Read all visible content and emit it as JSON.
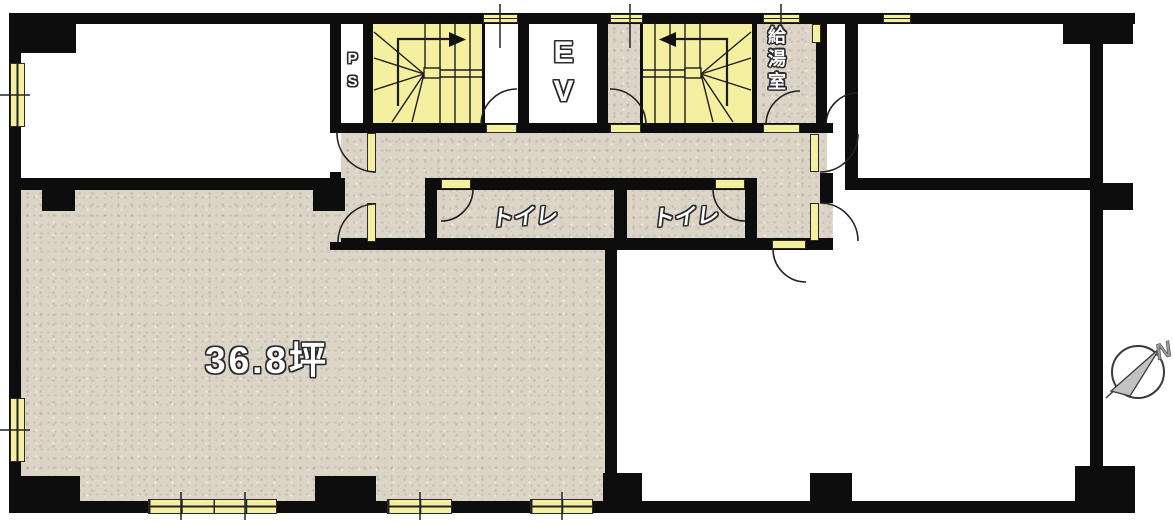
{
  "labels": {
    "main_room_area": "36.8坪",
    "toilet": "トイレ",
    "elevator": "EV",
    "pipe_shaft": "PS",
    "kitchenette": "給湯室",
    "compass_north": "N"
  },
  "colors": {
    "wall": "#0d0d0d",
    "floor_beige": "#dbd4c7",
    "fixture_yellow": "#f5f0a0",
    "room_white": "#ffffff"
  }
}
